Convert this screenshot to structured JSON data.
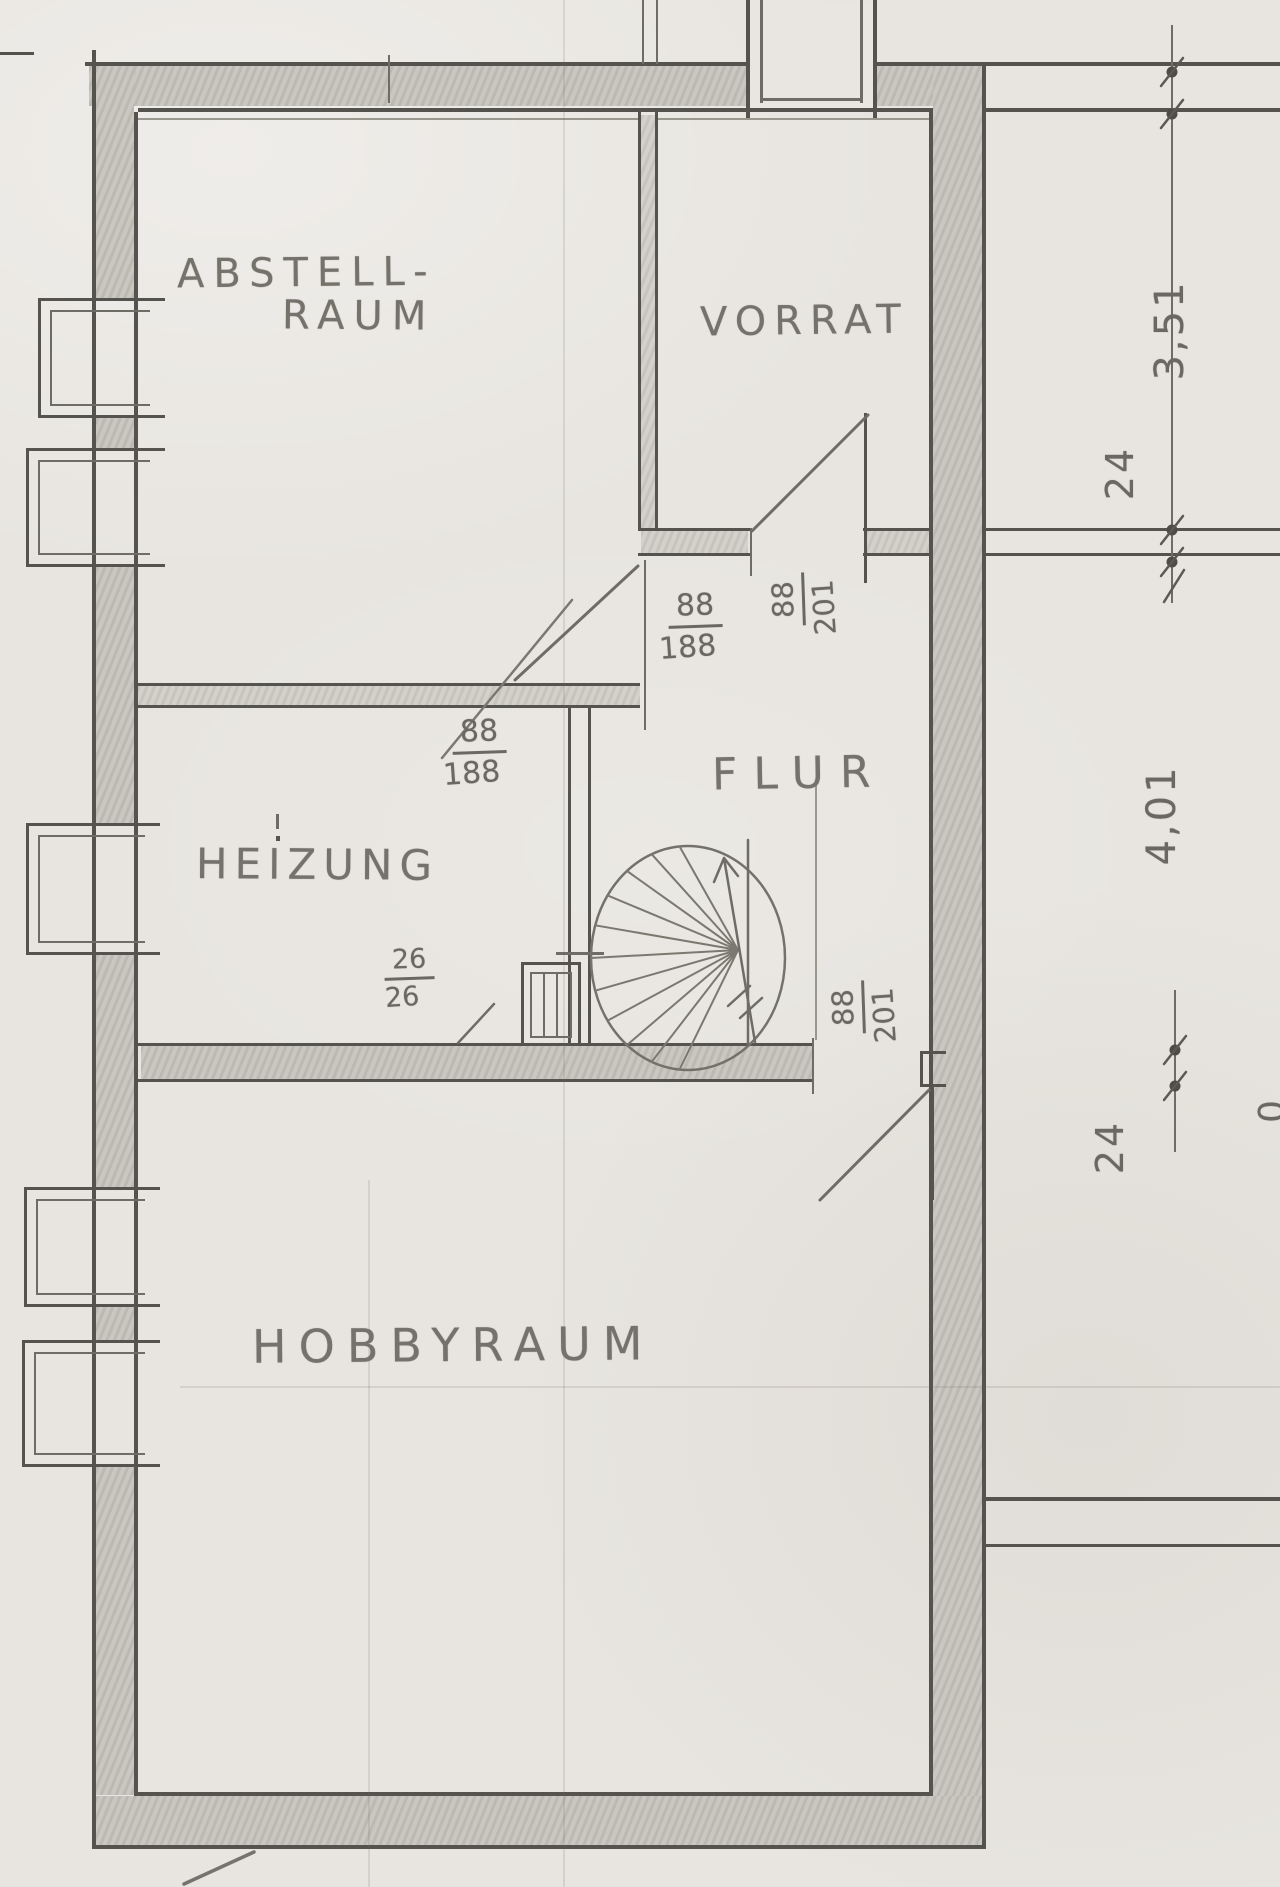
{
  "document": {
    "type": "hand-drawn basement floor plan",
    "language": "German"
  },
  "rooms": {
    "abstellraum": {
      "label_line1": "ABSTELL-",
      "label_line2": "RAUM"
    },
    "vorrat": {
      "label": "VORRAT"
    },
    "flur": {
      "label": "FLUR"
    },
    "heizung": {
      "label": "HEIZUNG"
    },
    "hobbyraum": {
      "label": "HOBBYRAUM"
    }
  },
  "door_dimensions": {
    "flur_abstell": {
      "numerator": "88",
      "denominator": "188"
    },
    "heizung": {
      "numerator": "88",
      "denominator": "188"
    },
    "vorrat": {
      "numerator": "88",
      "denominator": "201"
    },
    "hobbyraum": {
      "numerator": "88",
      "denominator": "201"
    },
    "niche": {
      "numerator": "26",
      "denominator": "26"
    }
  },
  "dimensions_right": {
    "vorrat_height": "3,51",
    "wall_top": "24",
    "flur_height": "4,01",
    "wall_bottom": "24",
    "partial_digit": "0"
  },
  "colors": {
    "paper": "#e8e5e0",
    "pencil_dark": "#55534e",
    "pencil_medium": "#6f6c65",
    "wall_fill": "#c2bfb8"
  }
}
